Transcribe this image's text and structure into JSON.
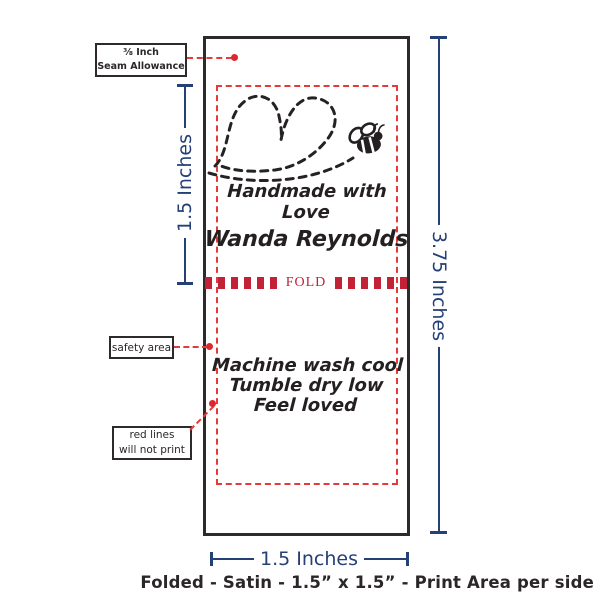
{
  "colors": {
    "navy": "#254076",
    "red_dash": "#e33b3c",
    "fold_red": "#c32136",
    "dot_red": "#e0262b",
    "ink": "#241f20",
    "outline": "#2e2a2b"
  },
  "label": {
    "front_line": "Handmade with Love",
    "name_line": "Wanda Reynolds",
    "fold_text": "FOLD",
    "care_lines": [
      "Machine wash cool",
      "Tumble dry low",
      "Feel loved"
    ]
  },
  "annotations": {
    "seam_allowance_line1": "⅜ Inch",
    "seam_allowance_line2": "Seam Allowance",
    "safety_area": "safety area",
    "red_lines_line1": "red lines",
    "red_lines_line2": "will not print"
  },
  "measurements": {
    "fold_half_height": "1.5 Inches",
    "total_height": "3.75 Inches",
    "width": "1.5 Inches"
  },
  "footer": {
    "caption": "Folded - Satin - 1.5” x 1.5” - Print Area per side"
  },
  "icons": {
    "heart": "stitched-heart-icon",
    "bee": "bee-icon"
  }
}
